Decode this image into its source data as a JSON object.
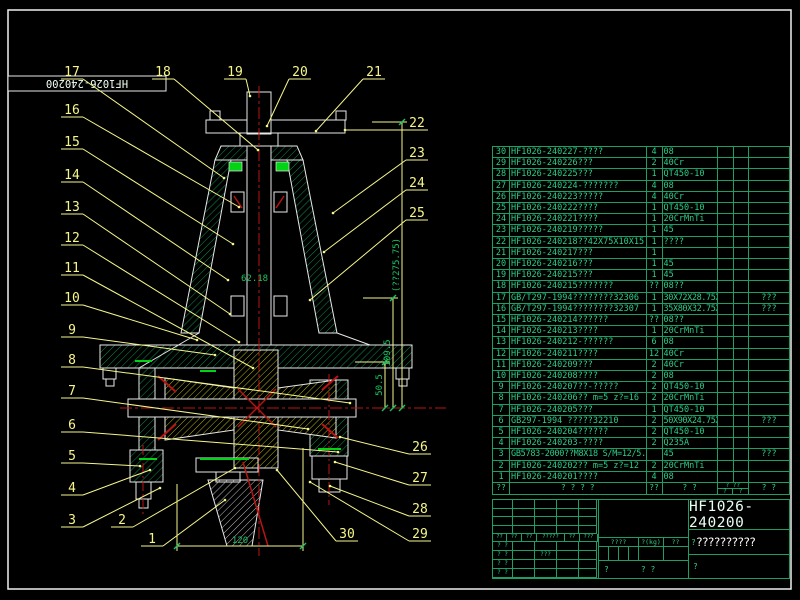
{
  "corner_label": "HF1026-240200",
  "colors": {
    "table_green": "#1d9e64",
    "text_green": "#2ecc86",
    "callout_yellow": "#f6f68a",
    "dim_green": "#19c460",
    "centerline_red": "#b81414",
    "seal_green": "#00d414",
    "outline_white": "#e8e8e8",
    "title_white": "#ffffff"
  },
  "parts_table": {
    "header": {
      "no": "??",
      "code": "? ?",
      "name": "? ?",
      "qty": "??",
      "material": "? ?",
      "weight_top": "? ??",
      "weight_left": "?",
      "weight_right": "?",
      "remark": "? ?"
    },
    "rows": [
      {
        "no": "30",
        "code": "HF1026-240227-????",
        "qty": "4",
        "material": "08",
        "remark": ""
      },
      {
        "no": "29",
        "code": "HF1026-240226???",
        "qty": "2",
        "material": "40Cr",
        "remark": ""
      },
      {
        "no": "28",
        "code": "HF1026-240225???",
        "qty": "1",
        "material": "QT450-10",
        "remark": ""
      },
      {
        "no": "27",
        "code": "HF1026-240224-???????",
        "qty": "4",
        "material": "08",
        "remark": ""
      },
      {
        "no": "26",
        "code": "HF1026-240223?????",
        "qty": "4",
        "material": "40Cr",
        "remark": ""
      },
      {
        "no": "25",
        "code": "HF1026-240222????",
        "qty": "1",
        "material": "QT450-10",
        "remark": ""
      },
      {
        "no": "24",
        "code": "HF1026-240221????",
        "qty": "1",
        "material": "20CrMnTi",
        "remark": ""
      },
      {
        "no": "23",
        "code": "HF1026-240219?????",
        "qty": "1",
        "material": "45",
        "remark": ""
      },
      {
        "no": "22",
        "code": "HF1026-240218??42X75X10X15",
        "qty": "1",
        "material": "????",
        "remark": ""
      },
      {
        "no": "21",
        "code": "HF1026-240217???",
        "qty": "1",
        "material": "",
        "remark": ""
      },
      {
        "no": "20",
        "code": "HF1026-240216???",
        "qty": "1",
        "material": "45",
        "remark": ""
      },
      {
        "no": "19",
        "code": "HF1026-240215???",
        "qty": "1",
        "material": "45",
        "remark": ""
      },
      {
        "no": "18",
        "code": "HF1026-240215???????",
        "qty": "??",
        "material": "08??",
        "remark": ""
      },
      {
        "no": "17",
        "code": "GB/T297-1994????????32306",
        "qty": "1",
        "material": "30X72X28.75X27X23",
        "material_small": true,
        "remark": "???"
      },
      {
        "no": "16",
        "code": "GB/T297-1994????????32307",
        "qty": "1",
        "material": "35X80X32.75X31X25",
        "material_small": true,
        "remark": "???"
      },
      {
        "no": "15",
        "code": "HF1026-240214??????",
        "qty": "??",
        "material": "08??",
        "remark": ""
      },
      {
        "no": "14",
        "code": "HF1026-240213????",
        "qty": "1",
        "material": "20CrMnTi",
        "remark": ""
      },
      {
        "no": "13",
        "code": "HF1026-240212-??????",
        "qty": "6",
        "material": "08",
        "remark": ""
      },
      {
        "no": "12",
        "code": "HF1026-240211????",
        "qty": "12",
        "material": "40Cr",
        "remark": ""
      },
      {
        "no": "11",
        "code": "HF1026-240209???",
        "qty": "2",
        "material": "40Cr",
        "remark": ""
      },
      {
        "no": "10",
        "code": "HF1026-240208????",
        "qty": "2",
        "material": "08",
        "remark": ""
      },
      {
        "no": "9",
        "code": "HF1026-240207??-?????",
        "qty": "2",
        "material": "QT450-10",
        "remark": ""
      },
      {
        "no": "8",
        "code": "HF1026-240206?? m=5 z?=16",
        "qty": "2",
        "material": "20CrMnTi",
        "remark": ""
      },
      {
        "no": "7",
        "code": "HF1026-240205???",
        "qty": "1",
        "material": "QT450-10",
        "remark": ""
      },
      {
        "no": "6",
        "code": "GB297-1994 ?????32210",
        "qty": "2",
        "material": "50X90X24.75X23X19",
        "material_small": true,
        "remark": "???"
      },
      {
        "no": "5",
        "code": "HF1026-240204??????",
        "qty": "2",
        "material": "QT450-10",
        "remark": ""
      },
      {
        "no": "4",
        "code": "HF1026-240203-????",
        "qty": "2",
        "material": "Q235A",
        "remark": ""
      },
      {
        "no": "3",
        "code": "GB5783-2000??M8X18 S/M=12/5.4",
        "desc_small": true,
        "qty": "",
        "material": "45",
        "remark": "???"
      },
      {
        "no": "2",
        "code": "HF1026-240202?? m=5 z?=12",
        "qty": "2",
        "material": "20CrMnTi",
        "remark": ""
      },
      {
        "no": "1",
        "code": "HF1026-240201????",
        "qty": "4",
        "material": "08",
        "remark": ""
      }
    ]
  },
  "title_block": {
    "drawing_no": "HF1026-240200",
    "product_name": "??????????",
    "name_prefix": "?",
    "stage_label": "????",
    "weight_label": "?(kg)",
    "scale_label": "??",
    "rev_header": [
      "??",
      "??",
      "??",
      "?????",
      "??",
      "???"
    ],
    "sign_rows": [
      [
        "? ?",
        ""
      ],
      [
        "? ?",
        "???"
      ],
      [
        "? ?",
        ""
      ],
      [
        "? ?",
        ""
      ]
    ],
    "sheet_left": "?",
    "sheet_mid": "? ?",
    "sheet_right": "?"
  },
  "callouts": [
    {
      "n": "17",
      "x": 72,
      "y": 75,
      "tx": 224,
      "ty": 178
    },
    {
      "n": "18",
      "x": 163,
      "y": 75,
      "tx": 258,
      "ty": 150
    },
    {
      "n": "19",
      "x": 235,
      "y": 75,
      "tx": 250,
      "ty": 96
    },
    {
      "n": "20",
      "x": 300,
      "y": 75,
      "tx": 267,
      "ty": 126
    },
    {
      "n": "21",
      "x": 374,
      "y": 75,
      "tx": 316,
      "ty": 131
    },
    {
      "n": "22",
      "x": 417,
      "y": 126,
      "tx": 345,
      "ty": 130
    },
    {
      "n": "23",
      "x": 417,
      "y": 156,
      "tx": 333,
      "ty": 213
    },
    {
      "n": "24",
      "x": 417,
      "y": 186,
      "tx": 324,
      "ty": 252
    },
    {
      "n": "25",
      "x": 417,
      "y": 216,
      "tx": 310,
      "ty": 300
    },
    {
      "n": "16",
      "x": 72,
      "y": 113,
      "tx": 239,
      "ty": 207
    },
    {
      "n": "15",
      "x": 72,
      "y": 145,
      "tx": 233,
      "ty": 244
    },
    {
      "n": "14",
      "x": 72,
      "y": 178,
      "tx": 228,
      "ty": 280
    },
    {
      "n": "13",
      "x": 72,
      "y": 210,
      "tx": 230,
      "ty": 314
    },
    {
      "n": "12",
      "x": 72,
      "y": 241,
      "tx": 239,
      "ty": 342
    },
    {
      "n": "11",
      "x": 72,
      "y": 271,
      "tx": 253,
      "ty": 368
    },
    {
      "n": "10",
      "x": 72,
      "y": 301,
      "tx": 197,
      "ty": 340
    },
    {
      "n": "9",
      "x": 72,
      "y": 333,
      "tx": 215,
      "ty": 355
    },
    {
      "n": "8",
      "x": 72,
      "y": 363,
      "tx": 350,
      "ty": 403
    },
    {
      "n": "7",
      "x": 72,
      "y": 394,
      "tx": 308,
      "ty": 429
    },
    {
      "n": "6",
      "x": 72,
      "y": 428,
      "tx": 338,
      "ty": 452
    },
    {
      "n": "5",
      "x": 72,
      "y": 459,
      "tx": 140,
      "ty": 466
    },
    {
      "n": "4",
      "x": 72,
      "y": 491,
      "tx": 150,
      "ty": 470
    },
    {
      "n": "3",
      "x": 72,
      "y": 523,
      "tx": 160,
      "ty": 488
    },
    {
      "n": "2",
      "x": 122,
      "y": 523,
      "tx": 235,
      "ty": 468
    },
    {
      "n": "1",
      "x": 152,
      "y": 542,
      "tx": 225,
      "ty": 500
    },
    {
      "n": "26",
      "x": 420,
      "y": 450,
      "tx": 340,
      "ty": 437
    },
    {
      "n": "27",
      "x": 420,
      "y": 481,
      "tx": 335,
      "ty": 462
    },
    {
      "n": "28",
      "x": 420,
      "y": 512,
      "tx": 330,
      "ty": 486
    },
    {
      "n": "29",
      "x": 420,
      "y": 537,
      "tx": 310,
      "ty": 482
    },
    {
      "n": "30",
      "x": 347,
      "y": 537,
      "tx": 277,
      "ty": 470
    }
  ],
  "dimensions": {
    "vertical": [
      {
        "text": "50.5",
        "x": 385,
        "y1": 362,
        "y2": 408
      },
      {
        "text": "109.5",
        "x": 393,
        "y1": 298,
        "y2": 408
      },
      {
        "text": "(??275.75)",
        "x": 402,
        "y1": 122,
        "y2": 408
      }
    ],
    "horizontal": {
      "text": "120",
      "x1": 177,
      "x2": 303,
      "y": 546
    },
    "note": {
      "text": "62.18",
      "x": 241,
      "y": 281
    }
  }
}
